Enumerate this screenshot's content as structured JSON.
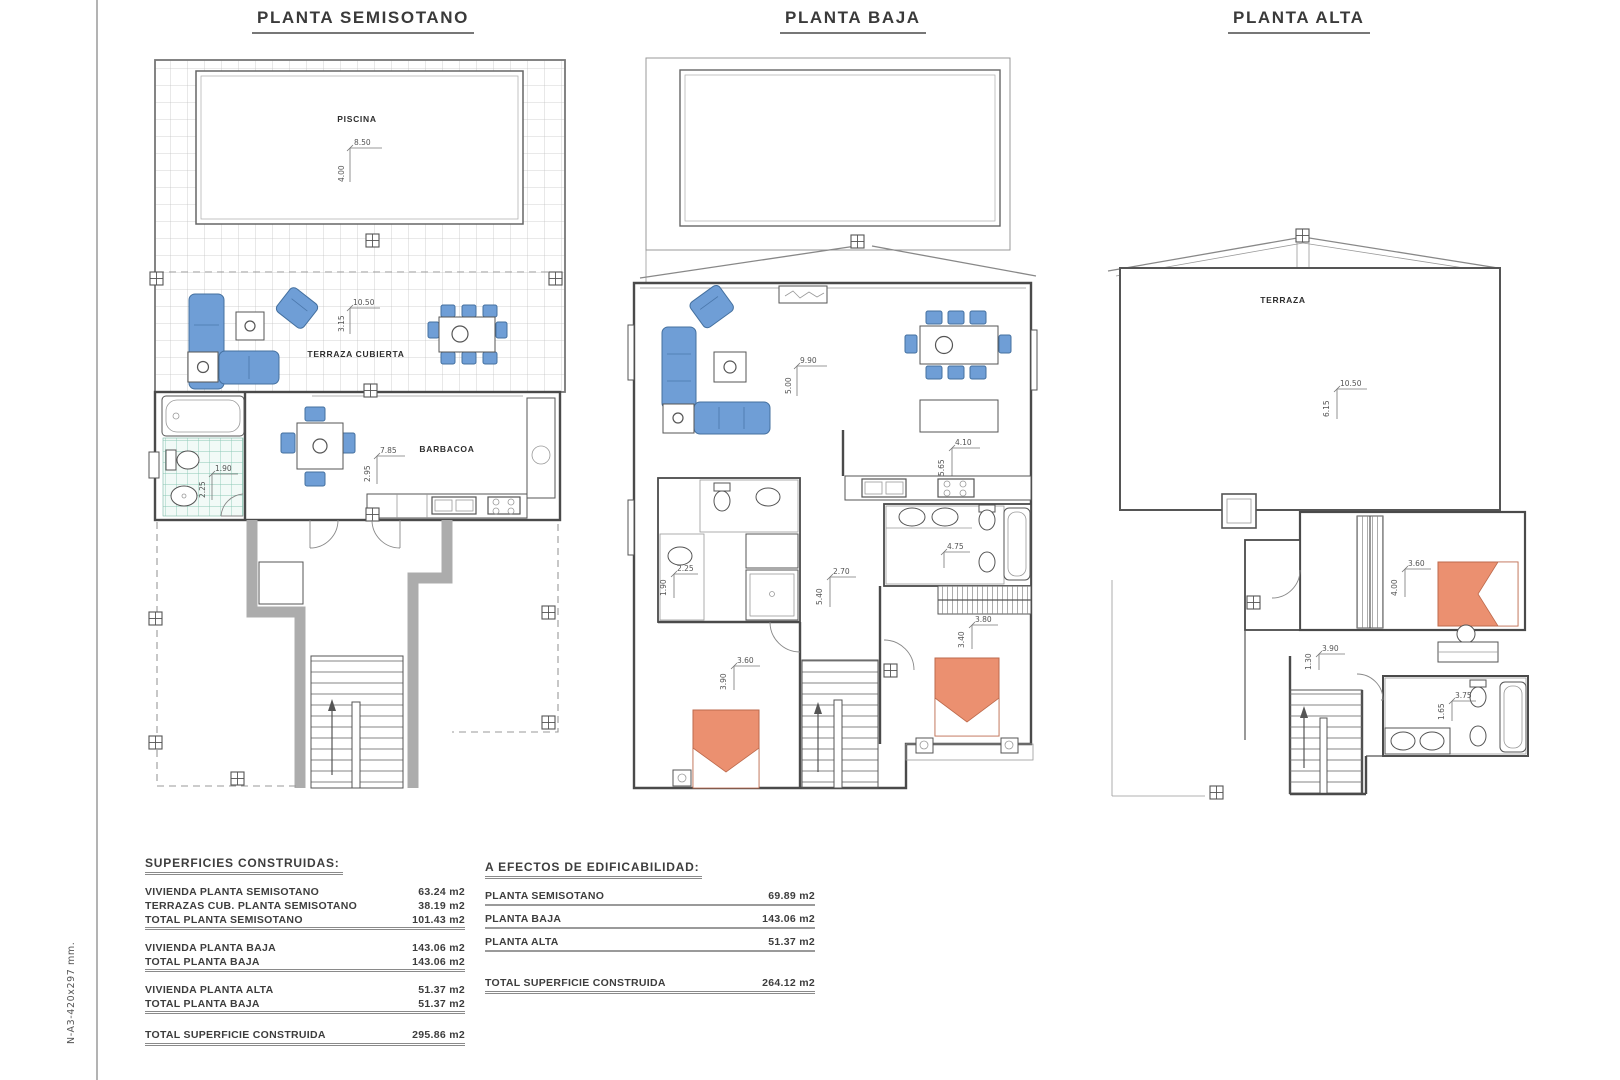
{
  "page": {
    "margin_note": "N-A3-420x297 mm."
  },
  "plans": {
    "semisotano": {
      "title": "PLANTA SEMISOTANO",
      "labels": {
        "piscina": "PISCINA",
        "terraza_cubierta": "TERRAZA CUBIERTA",
        "barbacoa": "BARBACOA"
      },
      "dims": {
        "pool_w": "8.50",
        "pool_h": "4.00",
        "terrace_w": "10.50",
        "terrace_h": "3.15",
        "bath_w": "1.90",
        "bath_h": "2.25",
        "barbacoa_w": "7.85",
        "barbacoa_h": "2.95"
      }
    },
    "baja": {
      "title": "PLANTA BAJA",
      "dims": {
        "living_w": "9.90",
        "living_h": "5.00",
        "kitchen_w": "4.10",
        "kitchen_h": "5.65",
        "bath1_w": "2.25",
        "bath1_h": "1.90",
        "hall_w": "2.70",
        "hall_h": "5.40",
        "bath2_w": "4.75",
        "bed1_w": "3.60",
        "bed1_h": "3.90",
        "bed2_w": "3.80",
        "bed2_h": "3.40"
      }
    },
    "alta": {
      "title": "PLANTA ALTA",
      "labels": {
        "terraza": "TERRAZA"
      },
      "dims": {
        "terrace_w": "10.50",
        "terrace_h": "6.15",
        "bed_w": "3.60",
        "bed_h": "4.00",
        "hall_w": "3.90",
        "hall_h": "1.30",
        "bath_w": "3.75",
        "bath_h": "1.65"
      }
    }
  },
  "tables": {
    "left": {
      "title": "SUPERFICIES CONSTRUIDAS:",
      "rows": [
        {
          "label": "VIVIENDA PLANTA SEMISOTANO",
          "value": "63.24 m2"
        },
        {
          "label": "TERRAZAS CUB. PLANTA SEMISOTANO",
          "value": "38.19 m2"
        },
        {
          "label": "TOTAL PLANTA SEMISOTANO",
          "value": "101.43 m2"
        },
        {
          "label": "VIVIENDA PLANTA BAJA",
          "value": "143.06 m2"
        },
        {
          "label": "TOTAL PLANTA BAJA",
          "value": "143.06 m2"
        },
        {
          "label": "VIVIENDA PLANTA ALTA",
          "value": "51.37 m2"
        },
        {
          "label": "TOTAL PLANTA BAJA",
          "value": "51.37 m2"
        }
      ],
      "total": {
        "label": "TOTAL SUPERFICIE CONSTRUIDA",
        "value": "295.86 m2"
      }
    },
    "right": {
      "title": "A EFECTOS DE EDIFICABILIDAD:",
      "rows": [
        {
          "label": "PLANTA SEMISOTANO",
          "value": "69.89 m2"
        },
        {
          "label": "PLANTA BAJA",
          "value": "143.06 m2"
        },
        {
          "label": "PLANTA ALTA",
          "value": "51.37 m2"
        }
      ],
      "total": {
        "label": "TOTAL SUPERFICIE CONSTRUIDA",
        "value": "264.12 m2"
      }
    }
  }
}
